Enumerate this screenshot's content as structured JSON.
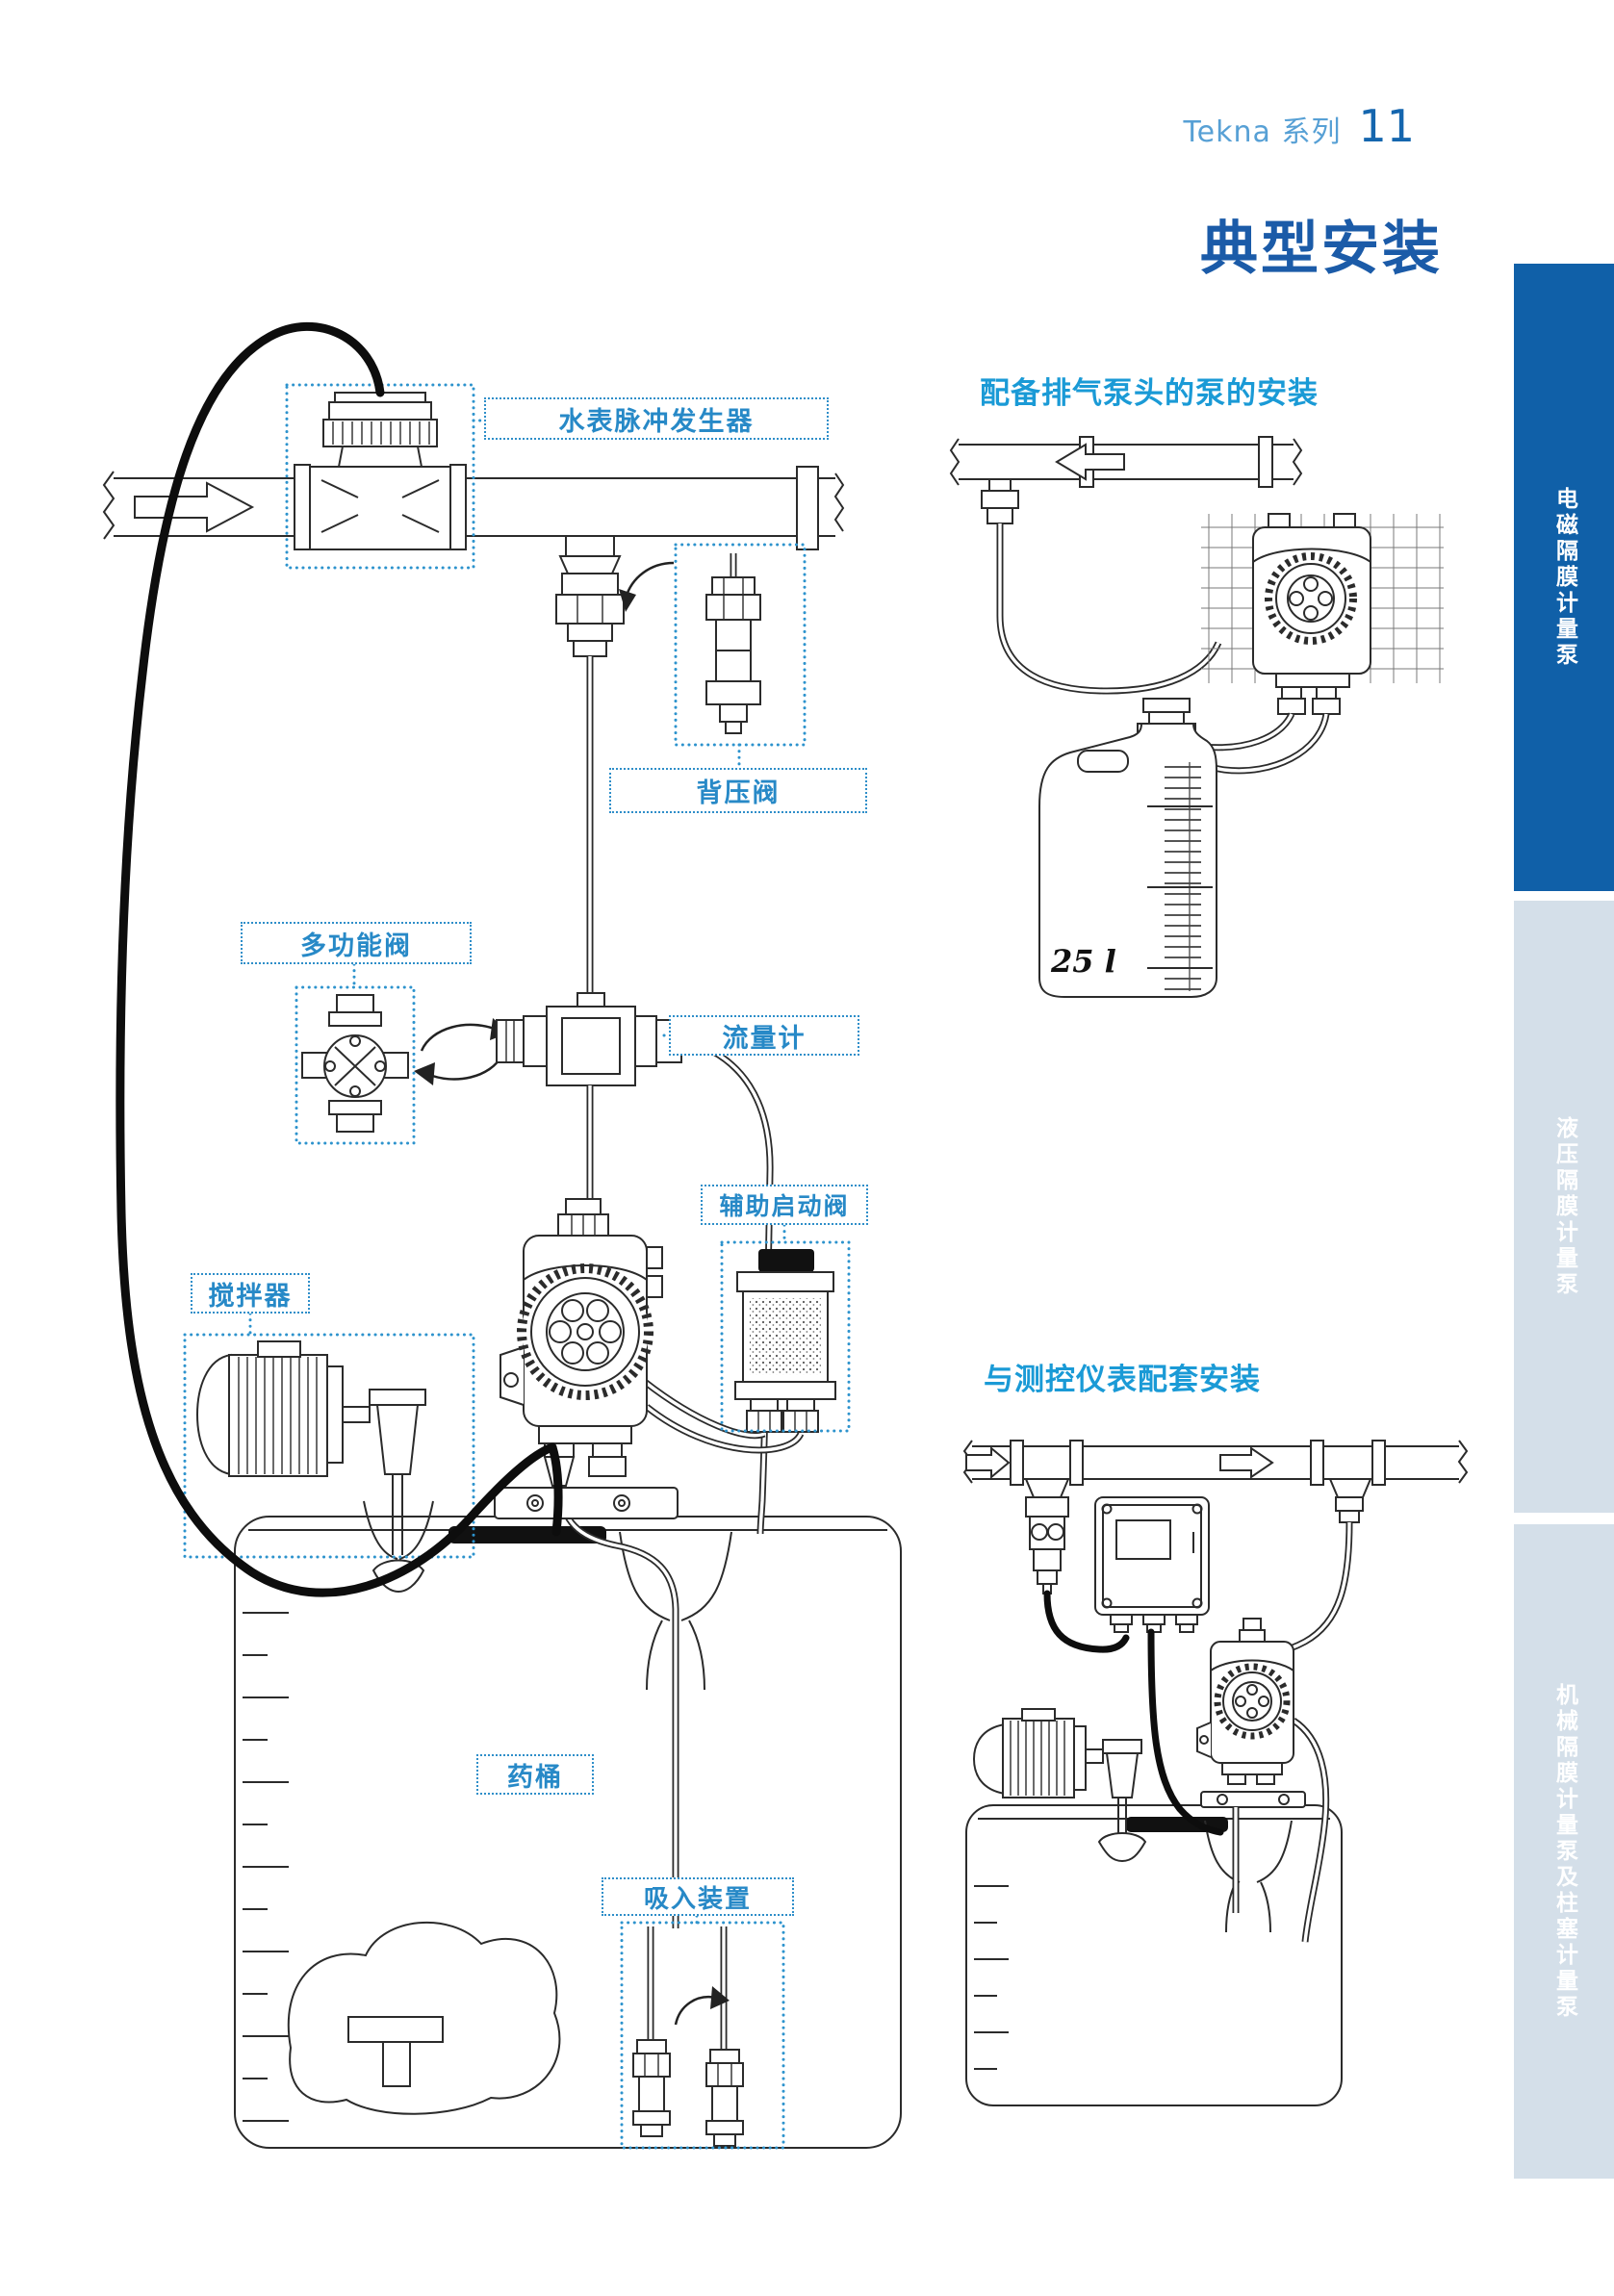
{
  "header": {
    "series_label": "Tekna 系列",
    "page_number": "11"
  },
  "title": "典型安装",
  "sidebar": {
    "tabs": [
      {
        "label": "电磁隔膜计量泵",
        "active": true,
        "color": "#1060a8"
      },
      {
        "label": "液压隔膜计量泵",
        "active": false,
        "color": "#d4dfe9"
      },
      {
        "label": "机械隔膜计量泵及柱塞计量泵",
        "active": false,
        "color": "#d4dfe9"
      }
    ]
  },
  "main_diagram": {
    "labels": {
      "water_meter": "水表脉冲发生器",
      "back_pressure_valve": "背压阀",
      "multifunction_valve": "多功能阀",
      "flow_meter": "流量计",
      "auxiliary_start_valve": "辅助启动阀",
      "agitator": "搅拌器",
      "chemical_tank": "药桶",
      "suction_device": "吸入装置"
    }
  },
  "right_diagrams": {
    "degassing": {
      "heading": "配备排气泵头的泵的安装",
      "tank_capacity_label": "25 l"
    },
    "instrument": {
      "heading": "与测控仪表配套安装"
    }
  },
  "colors": {
    "title_blue": "#1b5ba8",
    "subhead_cyan": "#1a9ad6",
    "label_blue": "#2789c7",
    "tab_active_blue": "#1060a8",
    "tab_inactive_blue": "#d4dfe9",
    "line_art": "#2b2b2b"
  }
}
